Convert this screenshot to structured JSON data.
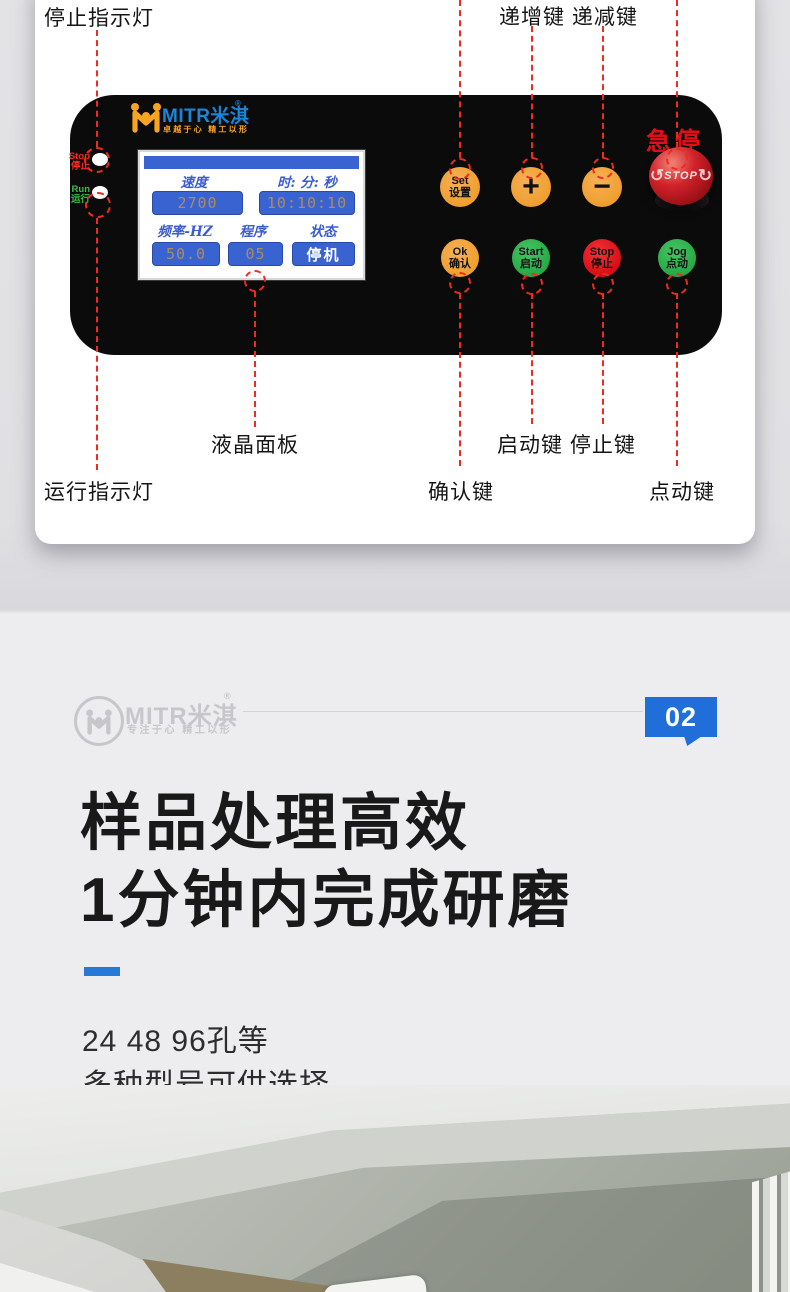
{
  "annotations": {
    "stop_indicator": "停止指示灯",
    "inc_dec": "递增键 递减键",
    "lcd_panel": "液晶面板",
    "run_indicator": "运行指示灯",
    "confirm": "确认键",
    "start_stop": "启动键 停止键",
    "jog": "点动键"
  },
  "panel": {
    "logo": {
      "brand": "MITR米淇",
      "reg": "®",
      "slogan": "卓越于心 精工以形"
    },
    "indicators": {
      "stop": {
        "en": "Stop",
        "zh": "停止"
      },
      "run": {
        "en": "Run",
        "zh": "运行"
      }
    },
    "lcd": {
      "speed_label": "速度",
      "speed_value": "2700",
      "time_label": "时: 分: 秒",
      "time_value": "10:10:10",
      "freq_label": "频率-HZ",
      "freq_value": "50.0",
      "prog_label": "程序",
      "prog_value": "05",
      "status_label": "状态",
      "status_value": "停机"
    },
    "buttons": {
      "set": {
        "en": "Set",
        "zh": "设置"
      },
      "plus": {
        "label": "+"
      },
      "minus": {
        "label": "−"
      },
      "ok": {
        "en": "Ok",
        "zh": "确认"
      },
      "start": {
        "en": "Start",
        "zh": "启动"
      },
      "stop": {
        "en": "Stop",
        "zh": "停止"
      },
      "jog": {
        "en": "Jog",
        "zh": "点动"
      }
    },
    "estop": {
      "label": "急停",
      "text": "STOP",
      "arrow_left": "↺",
      "arrow_right": "↻"
    }
  },
  "section": {
    "watermark": {
      "brand": "MITR米淇",
      "reg": "®",
      "slogan": "专注于心 精工以形"
    },
    "badge": "02",
    "heading_line1": "样品处理高效",
    "heading_line2": "1分钟内完成研磨",
    "sub_line1": "24 48 96孔等",
    "sub_line2": "多种型号可供选择"
  },
  "colors": {
    "accent_blue": "#1f6ed9",
    "annotation_red": "#ee2b1e",
    "button_orange": "#ef9f2e",
    "button_green": "#27a946",
    "button_red": "#d90d15",
    "lcd_blue": "#3a63d2",
    "logo_blue": "#1b86d9",
    "logo_orange": "#f7a421"
  }
}
